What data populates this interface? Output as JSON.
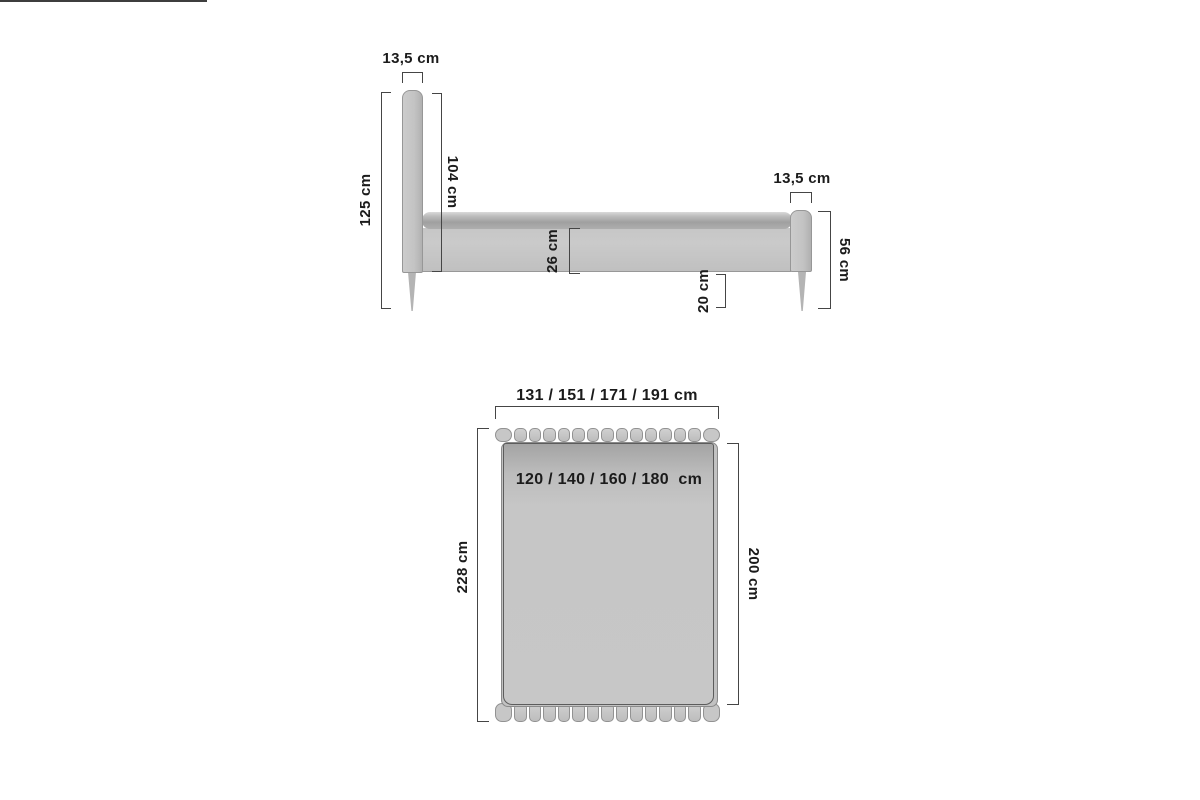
{
  "diagram": {
    "subject": "bed-dimensions-technical-drawing",
    "unit": "cm"
  },
  "side_view": {
    "headboard_thickness": "13,5 cm",
    "overall_height": "125 cm",
    "headboard_height": "104 cm",
    "frame_side_height": "26 cm",
    "underbed_clearance": "20 cm",
    "footboard_thickness": "13,5 cm",
    "footboard_height": "56 cm"
  },
  "top_view": {
    "overall_width_options": "131 / 151 / 171 / 191 cm",
    "mattress_width_options": "120 / 140 / 160 / 180  cm",
    "overall_length": "228 cm",
    "mattress_length": "200 cm"
  },
  "slats": {
    "headboard_count": 15,
    "footboard_count": 15
  },
  "colors": {
    "background": "#ffffff",
    "bed_fill": "#c6c6c6",
    "bed_fill_dark": "#a4a4a4",
    "outline": "#8f8f8f",
    "dimension_line": "#454545",
    "text": "#1b1b1b"
  }
}
